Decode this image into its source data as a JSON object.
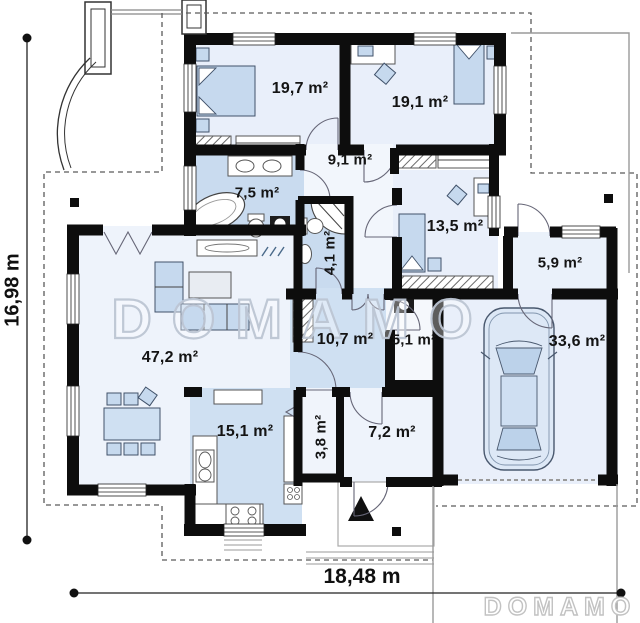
{
  "watermarks": {
    "center": "DOMAMO",
    "corner": "DOMAMO"
  },
  "dimensions": {
    "height": "16,98 m",
    "width": "18,48 m"
  },
  "rooms": {
    "bedroom1": "19,7 m²",
    "bedroom2": "19,1 m²",
    "corridor": "9,1 m²",
    "bathroom": "7,5 m²",
    "wc": "4,1 m²",
    "bedroom3": "13,5 m²",
    "entry": "5,9 m²",
    "living": "47,2 m²",
    "hall": "10,7 m²",
    "closet": "5,1 m²",
    "garage": "33,6 m²",
    "kitchen": "15,1 m²",
    "pantry": "3,8 m²",
    "utility": "7,2 m²"
  }
}
